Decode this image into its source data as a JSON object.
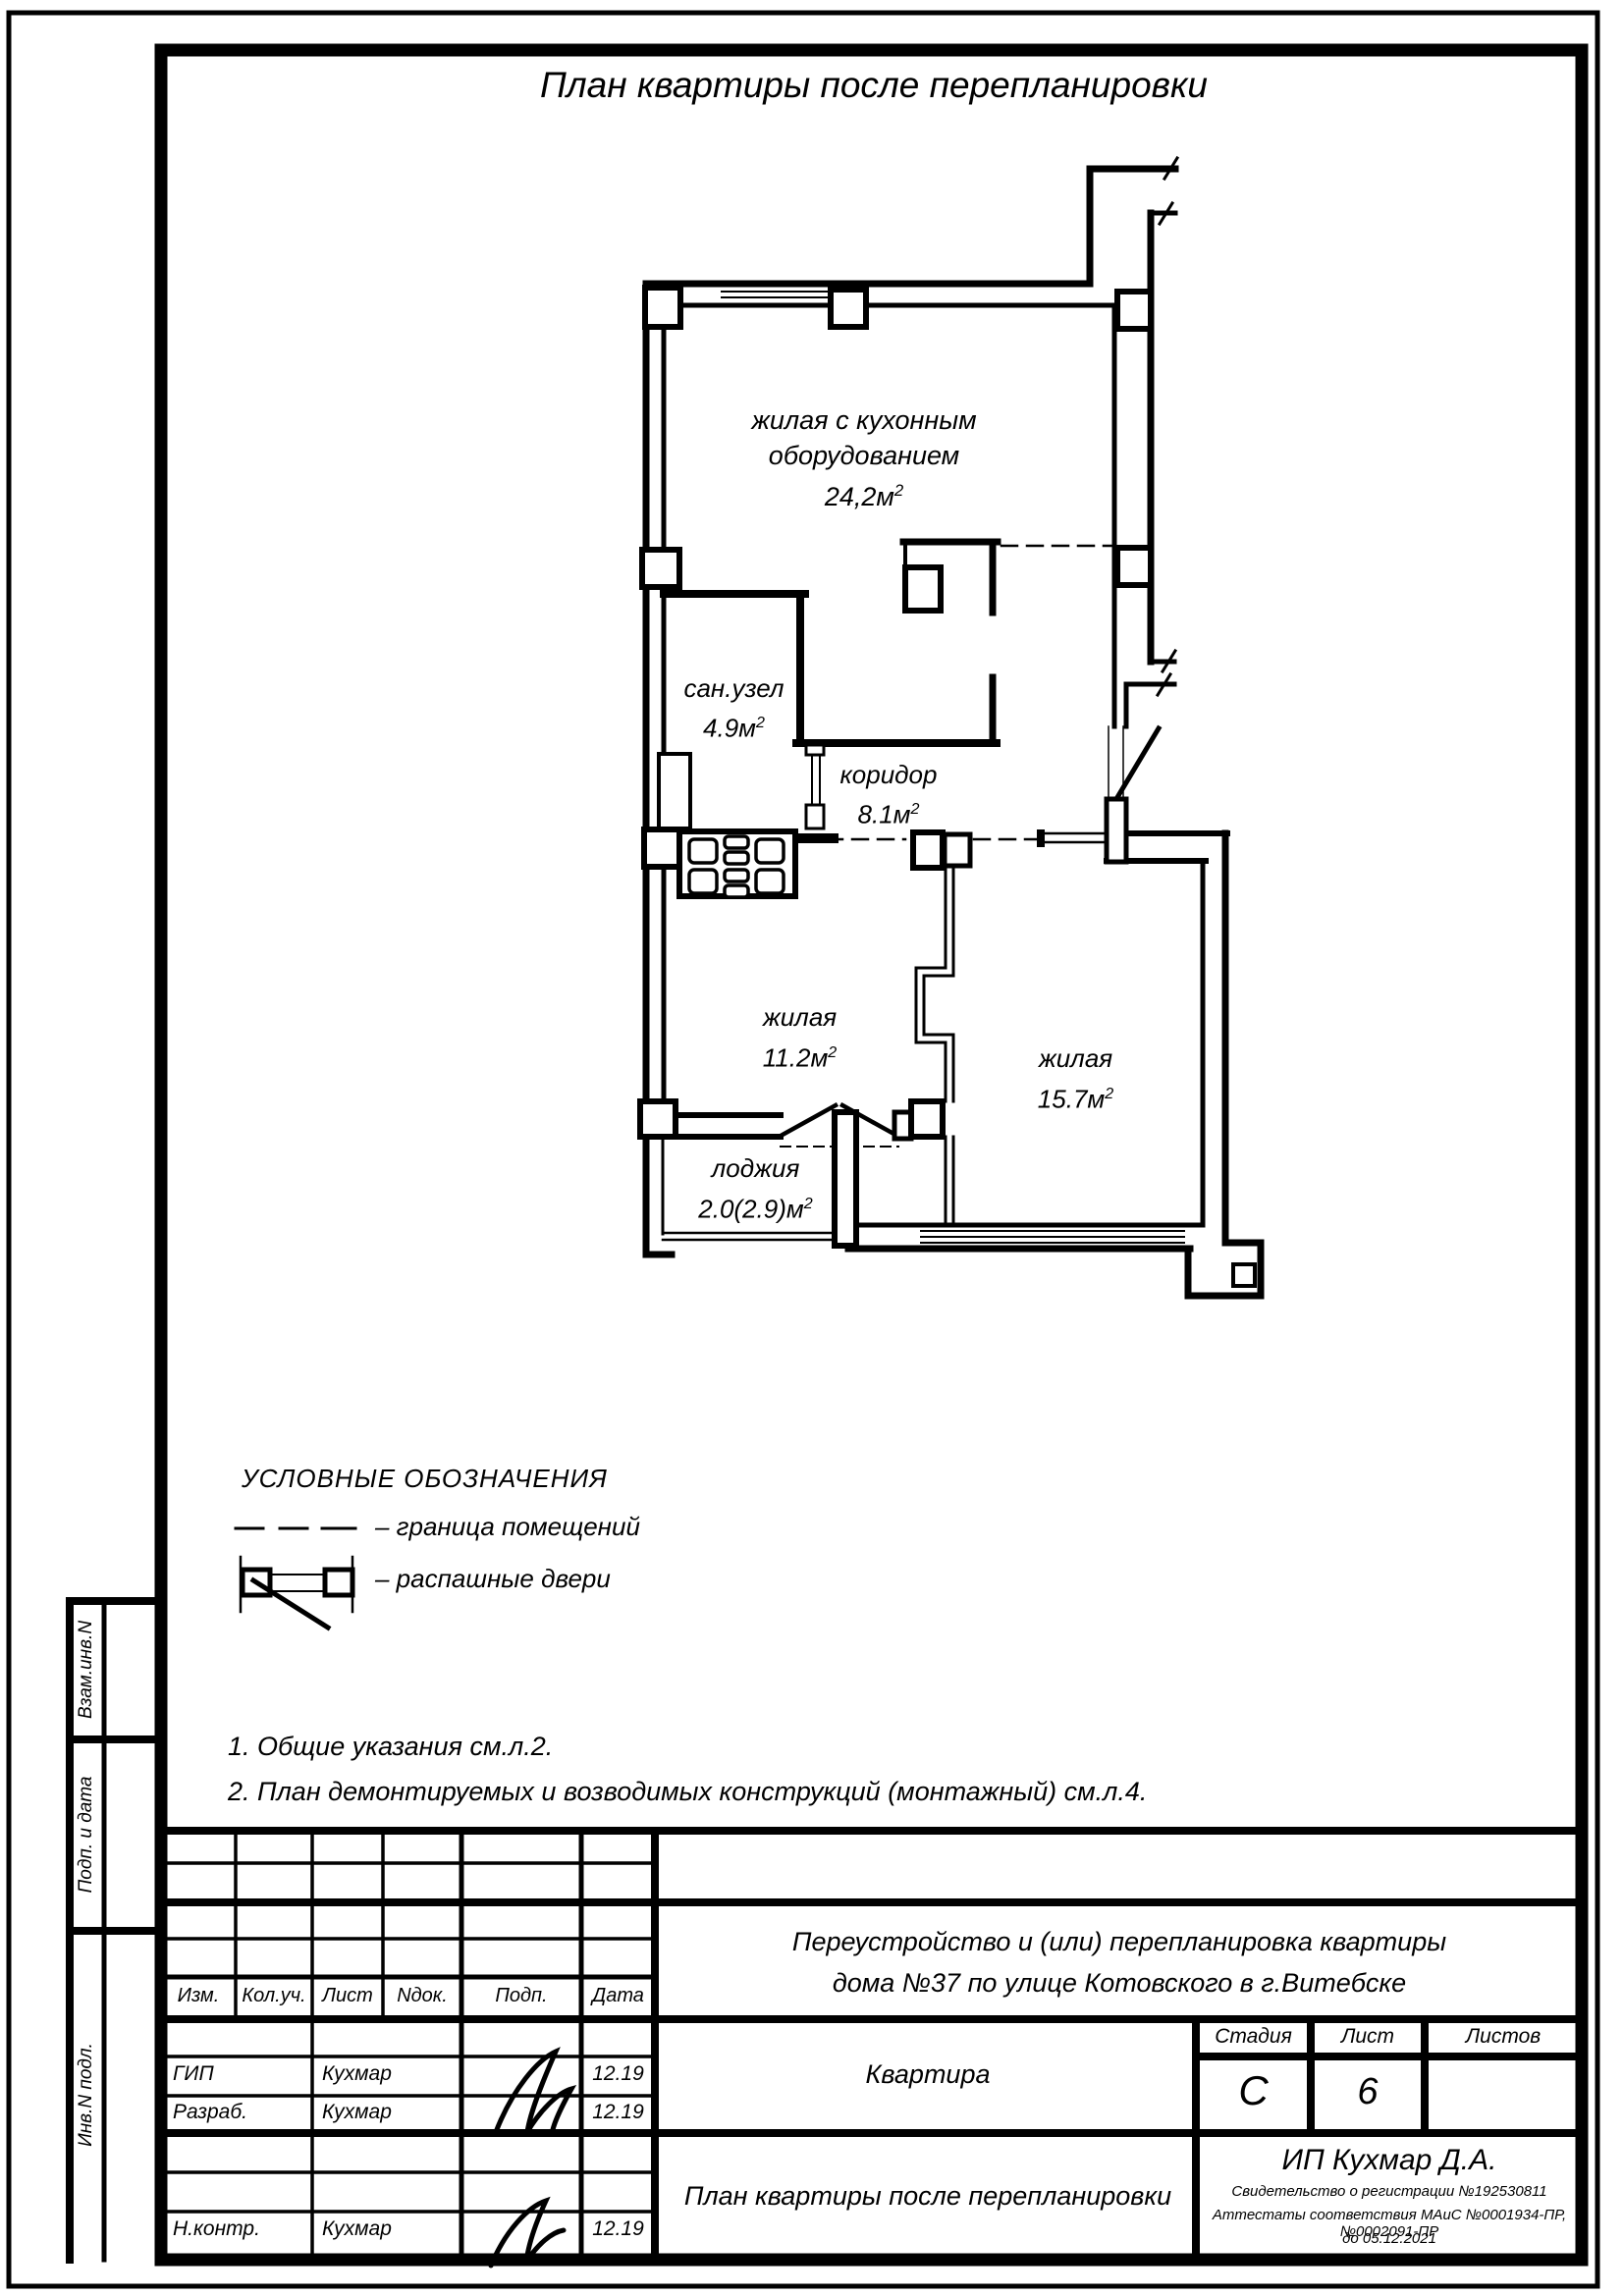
{
  "page": {
    "title": "План квартиры после перепланировки"
  },
  "plan": {
    "rooms": [
      {
        "id": "living-kitchen",
        "label": "жилая с кухонным",
        "label2": "оборудованием",
        "area": "24,2м",
        "sup": "2"
      },
      {
        "id": "bathroom",
        "label": "сан.узел",
        "area": "4.9м",
        "sup": "2"
      },
      {
        "id": "corridor",
        "label": "коридор",
        "area": "8.1м",
        "sup": "2"
      },
      {
        "id": "room-11",
        "label": "жилая",
        "area": "11.2м",
        "sup": "2"
      },
      {
        "id": "room-15",
        "label": "жилая",
        "area": "15.7м",
        "sup": "2"
      },
      {
        "id": "loggia",
        "label": "лоджия",
        "area": "2.0(2.9)м",
        "sup": "2"
      }
    ]
  },
  "legend": {
    "heading": "УСЛОВНЫЕ ОБОЗНАЧЕНИЯ",
    "items": [
      {
        "symbol": "dashed-line",
        "text": "–  граница помещений"
      },
      {
        "symbol": "double-swing-door",
        "text": "–  распашные двери"
      }
    ]
  },
  "notes": [
    "1. Общие указания см.л.2.",
    "2. План демонтируемых и возводимых конструкций (монтажный) см.л.4."
  ],
  "sidebar": {
    "labels": [
      "Взам.инв.N",
      "Подп. и дата",
      "Инв.N подл."
    ]
  },
  "titleblock": {
    "header_cols": [
      "Изм.",
      "Кол.уч.",
      "Лист",
      "Nдок.",
      "Подп.",
      "Дата"
    ],
    "rows": [
      {
        "role": "ГИП",
        "name": "Кухмар",
        "date": "12.19"
      },
      {
        "role": "Разраб.",
        "name": "Кухмар",
        "date": "12.19"
      },
      {
        "role": "Н.контр.",
        "name": "Кухмар",
        "date": "12.19"
      }
    ],
    "project_line1": "Переустройство и (или) перепланировка квартиры",
    "project_line2": "дома №37 по улице Котовского в г.Витебске",
    "object_label": "Квартира",
    "stage_label": "Стадия",
    "sheet_label": "Лист",
    "sheets_label": "Листов",
    "stage_value": "С",
    "sheet_value": "6",
    "sheets_value": "",
    "drawing_title": "План квартиры после перепланировки",
    "company": "ИП Кухмар Д.А.",
    "cert_lines": [
      "Свидетельство о регистрации №192530811",
      "Аттестаты соответствия МАиС №0001934-ПР, №0002091-ПР",
      "до 05.12.2021"
    ]
  }
}
